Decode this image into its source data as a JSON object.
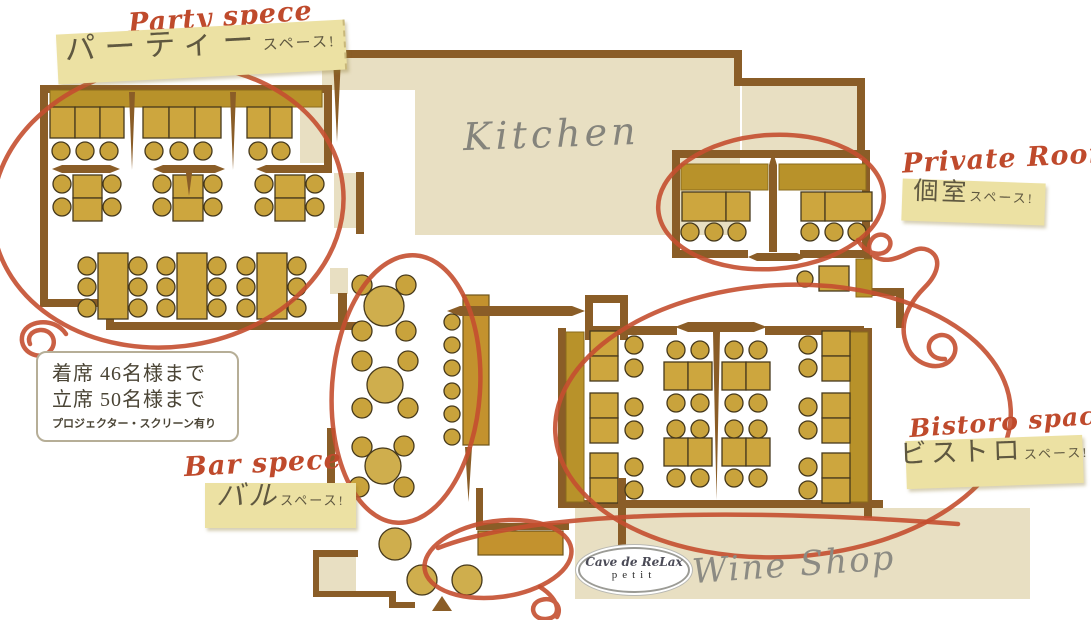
{
  "title": "Restaurant floor plan",
  "colors": {
    "wall": "#8a5d27",
    "floor_beige": "#e8dfc2",
    "banquette": "#b8922a",
    "table": "#cda63e",
    "table_border": "#46391c",
    "counter": "#c3922e",
    "tag_background": "#ece1a3",
    "annotation_red": "#c44f30",
    "script_red": "#bf4a2c",
    "gray_label": "#85847c"
  },
  "rooms": {
    "party": {
      "script_label": "Party spece",
      "tag_main": "パーティー",
      "tag_suffix": "スペース!",
      "seated": "着席 46名様まで",
      "standing": "立席 50名様まで",
      "note": "プロジェクター・スクリーン有り"
    },
    "private": {
      "script_label": "Private Room",
      "tag_main": "個室",
      "tag_suffix": "スペース!"
    },
    "bistoro": {
      "script_label": "Bistoro space",
      "tag_main": "ビストロ",
      "tag_suffix": "スペース!"
    },
    "bar": {
      "script_label": "Bar spece",
      "tag_main": "バル",
      "tag_suffix": "スペース!"
    },
    "kitchen": {
      "label": "Kitchen"
    },
    "wine_shop": {
      "label": "Wine Shop",
      "logo_main": "Cave de ReLax",
      "logo_sub": "petit"
    }
  },
  "plan": {
    "rects": [
      [
        322,
        58,
        418,
        32,
        "bg"
      ],
      [
        415,
        90,
        325,
        145,
        "bg"
      ],
      [
        742,
        86,
        115,
        66,
        "bg"
      ],
      [
        300,
        93,
        24,
        70,
        "bg"
      ],
      [
        334,
        173,
        22,
        55,
        "bg"
      ],
      [
        330,
        268,
        18,
        26,
        "bg"
      ],
      [
        318,
        557,
        38,
        34,
        "bg"
      ],
      [
        575,
        508,
        455,
        91,
        "bg"
      ],
      [
        40,
        85,
        8,
        222,
        "w"
      ],
      [
        40,
        85,
        292,
        8,
        "w"
      ],
      [
        324,
        85,
        8,
        88,
        "w"
      ],
      [
        298,
        165,
        32,
        8,
        "w"
      ],
      [
        40,
        299,
        74,
        8,
        "w"
      ],
      [
        106,
        299,
        8,
        31,
        "w"
      ],
      [
        106,
        322,
        252,
        8,
        "w"
      ],
      [
        338,
        293,
        9,
        37,
        "w"
      ],
      [
        356,
        172,
        8,
        62,
        "w"
      ],
      [
        322,
        50,
        420,
        8,
        "w"
      ],
      [
        734,
        56,
        8,
        28,
        "w"
      ],
      [
        734,
        78,
        130,
        8,
        "w"
      ],
      [
        857,
        78,
        8,
        78,
        "w"
      ],
      [
        672,
        150,
        198,
        8,
        "w"
      ],
      [
        672,
        150,
        8,
        108,
        "w"
      ],
      [
        862,
        150,
        8,
        108,
        "w"
      ],
      [
        676,
        250,
        72,
        8,
        "w"
      ],
      [
        800,
        250,
        70,
        8,
        "w"
      ],
      [
        585,
        295,
        8,
        45,
        "w"
      ],
      [
        585,
        295,
        43,
        8,
        "w"
      ],
      [
        620,
        303,
        8,
        37,
        "w"
      ],
      [
        593,
        326,
        84,
        9,
        "w"
      ],
      [
        765,
        326,
        99,
        9,
        "w"
      ],
      [
        862,
        288,
        42,
        8,
        "w"
      ],
      [
        896,
        288,
        8,
        40,
        "w"
      ],
      [
        558,
        328,
        8,
        180,
        "w"
      ],
      [
        864,
        328,
        8,
        190,
        "w"
      ],
      [
        558,
        500,
        325,
        8,
        "w"
      ],
      [
        327,
        428,
        8,
        60,
        "w"
      ],
      [
        327,
        483,
        29,
        7,
        "w"
      ],
      [
        349,
        483,
        7,
        32,
        "w"
      ],
      [
        313,
        550,
        45,
        7,
        "w"
      ],
      [
        313,
        550,
        6,
        47,
        "w"
      ],
      [
        313,
        591,
        82,
        6,
        "w"
      ],
      [
        389,
        591,
        7,
        17,
        "w"
      ],
      [
        389,
        602,
        26,
        6,
        "w"
      ],
      [
        476,
        488,
        7,
        42,
        "w"
      ],
      [
        476,
        523,
        93,
        7,
        "w"
      ],
      [
        864,
        255,
        8,
        38,
        "w"
      ],
      [
        50,
        90,
        272,
        17,
        "bq"
      ],
      [
        681,
        164,
        87,
        26,
        "bq"
      ],
      [
        779,
        164,
        87,
        26,
        "bq"
      ],
      [
        566,
        332,
        18,
        170,
        "bq"
      ],
      [
        850,
        332,
        18,
        170,
        "bq"
      ],
      [
        856,
        259,
        16,
        38,
        "bq"
      ],
      [
        50,
        107,
        25,
        31,
        "t"
      ],
      [
        75,
        107,
        25,
        31,
        "t"
      ],
      [
        100,
        107,
        24,
        31,
        "t"
      ],
      [
        143,
        107,
        26,
        31,
        "t"
      ],
      [
        169,
        107,
        26,
        31,
        "t"
      ],
      [
        195,
        107,
        26,
        31,
        "t"
      ],
      [
        247,
        107,
        23,
        31,
        "t"
      ],
      [
        270,
        107,
        22,
        31,
        "t"
      ],
      [
        73,
        175,
        29,
        23,
        "t"
      ],
      [
        73,
        198,
        29,
        23,
        "t"
      ],
      [
        173,
        175,
        30,
        23,
        "t"
      ],
      [
        173,
        198,
        30,
        23,
        "t"
      ],
      [
        275,
        175,
        30,
        23,
        "t"
      ],
      [
        275,
        198,
        30,
        23,
        "t"
      ],
      [
        98,
        253,
        30,
        66,
        "t"
      ],
      [
        177,
        253,
        30,
        66,
        "t"
      ],
      [
        257,
        253,
        30,
        66,
        "t"
      ],
      [
        682,
        192,
        44,
        29,
        "t"
      ],
      [
        726,
        192,
        24,
        29,
        "t"
      ],
      [
        801,
        192,
        24,
        29,
        "t"
      ],
      [
        825,
        192,
        47,
        29,
        "t"
      ],
      [
        819,
        266,
        30,
        25,
        "t"
      ],
      [
        590,
        331,
        28,
        25,
        "t"
      ],
      [
        590,
        356,
        28,
        25,
        "t"
      ],
      [
        590,
        393,
        28,
        25,
        "t"
      ],
      [
        590,
        418,
        28,
        25,
        "t"
      ],
      [
        590,
        453,
        28,
        25,
        "t"
      ],
      [
        590,
        478,
        28,
        25,
        "t"
      ],
      [
        822,
        331,
        28,
        25,
        "t"
      ],
      [
        822,
        356,
        28,
        25,
        "t"
      ],
      [
        822,
        393,
        28,
        25,
        "t"
      ],
      [
        822,
        418,
        28,
        25,
        "t"
      ],
      [
        822,
        453,
        28,
        25,
        "t"
      ],
      [
        822,
        478,
        28,
        25,
        "t"
      ],
      [
        664,
        362,
        24,
        28,
        "t"
      ],
      [
        688,
        362,
        24,
        28,
        "t"
      ],
      [
        664,
        438,
        24,
        28,
        "t"
      ],
      [
        688,
        438,
        24,
        28,
        "t"
      ],
      [
        722,
        362,
        24,
        28,
        "t"
      ],
      [
        746,
        362,
        24,
        28,
        "t"
      ],
      [
        722,
        438,
        24,
        28,
        "t"
      ],
      [
        746,
        438,
        24,
        28,
        "t"
      ],
      [
        463,
        295,
        26,
        150,
        "cnt"
      ],
      [
        478,
        531,
        85,
        24,
        "cnt"
      ]
    ],
    "wall_paths": [
      "M333,58 H341 L337,142 Z",
      "M129,92 H135 L132,170 Z",
      "M230,92 H236 L233,170 Z",
      "M52,169 L62,165 H110 L120,169 L110,173 H62 Z",
      "M153,169 L163,165 H215 L225,169 L215,173 H163 Z",
      "M256,169 L266,165 H318 L328,169 L318,173 H266 Z",
      "M186,173 H192 L189,196 Z",
      "M769,252 V165 L773,152 L777,165 V252 Z",
      "M447,311 L460,306 H572 L585,311 L572,316 H460 Z",
      "M675,327 L688,322 H754 L767,327 L754,332 H688 Z",
      "M748,257 L757,253 H797 L806,257 L797,261 H757 Z",
      "M713,332 H720 L716.5,500 Z",
      "M465,447 H472 L468.5,502 Z",
      "M618,478 H626 V560 L622,584 L618,560 Z",
      "M442,596 L452,611 H432 Z"
    ],
    "circles": [
      [
        61,
        151,
        9,
        "ch"
      ],
      [
        85,
        151,
        9,
        "ch"
      ],
      [
        109,
        151,
        9,
        "ch"
      ],
      [
        154,
        151,
        9,
        "ch"
      ],
      [
        179,
        151,
        9,
        "ch"
      ],
      [
        203,
        151,
        9,
        "ch"
      ],
      [
        258,
        151,
        9,
        "ch"
      ],
      [
        281,
        151,
        9,
        "ch"
      ],
      [
        62,
        184,
        9,
        "ch"
      ],
      [
        62,
        207,
        9,
        "ch"
      ],
      [
        112,
        184,
        9,
        "ch"
      ],
      [
        112,
        207,
        9,
        "ch"
      ],
      [
        162,
        184,
        9,
        "ch"
      ],
      [
        162,
        207,
        9,
        "ch"
      ],
      [
        213,
        184,
        9,
        "ch"
      ],
      [
        213,
        207,
        9,
        "ch"
      ],
      [
        264,
        184,
        9,
        "ch"
      ],
      [
        264,
        207,
        9,
        "ch"
      ],
      [
        315,
        184,
        9,
        "ch"
      ],
      [
        315,
        207,
        9,
        "ch"
      ],
      [
        87,
        266,
        9,
        "ch"
      ],
      [
        87,
        287,
        9,
        "ch"
      ],
      [
        87,
        308,
        9,
        "ch"
      ],
      [
        138,
        266,
        9,
        "ch"
      ],
      [
        138,
        287,
        9,
        "ch"
      ],
      [
        138,
        308,
        9,
        "ch"
      ],
      [
        166,
        266,
        9,
        "ch"
      ],
      [
        166,
        287,
        9,
        "ch"
      ],
      [
        166,
        308,
        9,
        "ch"
      ],
      [
        217,
        266,
        9,
        "ch"
      ],
      [
        217,
        287,
        9,
        "ch"
      ],
      [
        217,
        308,
        9,
        "ch"
      ],
      [
        246,
        266,
        9,
        "ch"
      ],
      [
        246,
        287,
        9,
        "ch"
      ],
      [
        246,
        308,
        9,
        "ch"
      ],
      [
        297,
        266,
        9,
        "ch"
      ],
      [
        297,
        287,
        9,
        "ch"
      ],
      [
        297,
        308,
        9,
        "ch"
      ],
      [
        690,
        232,
        9,
        "ch"
      ],
      [
        714,
        232,
        9,
        "ch"
      ],
      [
        737,
        232,
        9,
        "ch"
      ],
      [
        810,
        232,
        9,
        "ch"
      ],
      [
        834,
        232,
        9,
        "ch"
      ],
      [
        857,
        232,
        9,
        "ch"
      ],
      [
        805,
        279,
        8,
        "ch"
      ],
      [
        452,
        322,
        8,
        "ch"
      ],
      [
        452,
        345,
        8,
        "ch"
      ],
      [
        452,
        368,
        8,
        "ch"
      ],
      [
        452,
        391,
        8,
        "ch"
      ],
      [
        452,
        414,
        8,
        "ch"
      ],
      [
        452,
        437,
        8,
        "ch"
      ],
      [
        362,
        285,
        10,
        "ch"
      ],
      [
        406,
        285,
        10,
        "ch"
      ],
      [
        362,
        331,
        10,
        "ch"
      ],
      [
        406,
        331,
        10,
        "ch"
      ],
      [
        362,
        361,
        10,
        "ch"
      ],
      [
        408,
        361,
        10,
        "ch"
      ],
      [
        362,
        408,
        10,
        "ch"
      ],
      [
        408,
        408,
        10,
        "ch"
      ],
      [
        362,
        447,
        10,
        "ch"
      ],
      [
        404,
        446,
        10,
        "ch"
      ],
      [
        359,
        487,
        10,
        "ch"
      ],
      [
        404,
        487,
        10,
        "ch"
      ],
      [
        634,
        345,
        9,
        "ch"
      ],
      [
        634,
        368,
        9,
        "ch"
      ],
      [
        634,
        407,
        9,
        "ch"
      ],
      [
        634,
        430,
        9,
        "ch"
      ],
      [
        634,
        467,
        9,
        "ch"
      ],
      [
        634,
        490,
        9,
        "ch"
      ],
      [
        808,
        345,
        9,
        "ch"
      ],
      [
        808,
        368,
        9,
        "ch"
      ],
      [
        808,
        407,
        9,
        "ch"
      ],
      [
        808,
        430,
        9,
        "ch"
      ],
      [
        808,
        467,
        9,
        "ch"
      ],
      [
        808,
        490,
        9,
        "ch"
      ],
      [
        676,
        350,
        9,
        "ch"
      ],
      [
        700,
        350,
        9,
        "ch"
      ],
      [
        676,
        403,
        9,
        "ch"
      ],
      [
        700,
        403,
        9,
        "ch"
      ],
      [
        676,
        429,
        9,
        "ch"
      ],
      [
        700,
        429,
        9,
        "ch"
      ],
      [
        676,
        478,
        9,
        "ch"
      ],
      [
        700,
        478,
        9,
        "ch"
      ],
      [
        734,
        350,
        9,
        "ch"
      ],
      [
        758,
        350,
        9,
        "ch"
      ],
      [
        734,
        403,
        9,
        "ch"
      ],
      [
        758,
        403,
        9,
        "ch"
      ],
      [
        734,
        429,
        9,
        "ch"
      ],
      [
        758,
        429,
        9,
        "ch"
      ],
      [
        734,
        478,
        9,
        "ch"
      ],
      [
        758,
        478,
        9,
        "ch"
      ],
      [
        384,
        306,
        20,
        "rt"
      ],
      [
        385,
        385,
        18,
        "rt"
      ],
      [
        383,
        466,
        18,
        "rt"
      ],
      [
        395,
        544,
        16,
        "rt"
      ],
      [
        422,
        580,
        15,
        "rt"
      ],
      [
        467,
        580,
        15,
        "rt"
      ]
    ],
    "red_ellipses": [
      [
        168,
        206,
        176,
        141,
        -7
      ],
      [
        771,
        202,
        113,
        67,
        -4
      ],
      [
        783,
        421,
        228,
        136,
        -3
      ],
      [
        406,
        389,
        74,
        134,
        4
      ],
      [
        498,
        559,
        74,
        38,
        -8
      ]
    ],
    "red_paths": [
      "M66,334 C54,316 24,320 22,337 C20,352 39,361 49,352 C59,343 52,329 40,330 C31,331 27,337 30,344",
      "M858,240 C866,256 886,258 890,246 C893,236 879,230 872,239 C863,251 876,263 893,259 C910,255 915,245 928,250 C943,257 938,274 925,287 C908,304 898,324 907,346 C915,367 943,373 953,357 C961,343 947,330 935,337 C924,343 928,360 945,359",
      "M438,548 C530,512 726,507 958,524",
      "M540,587 C561,600 562,618 546,619 C532,620 528,604 541,600 C553,596 563,606 557,617"
    ]
  }
}
